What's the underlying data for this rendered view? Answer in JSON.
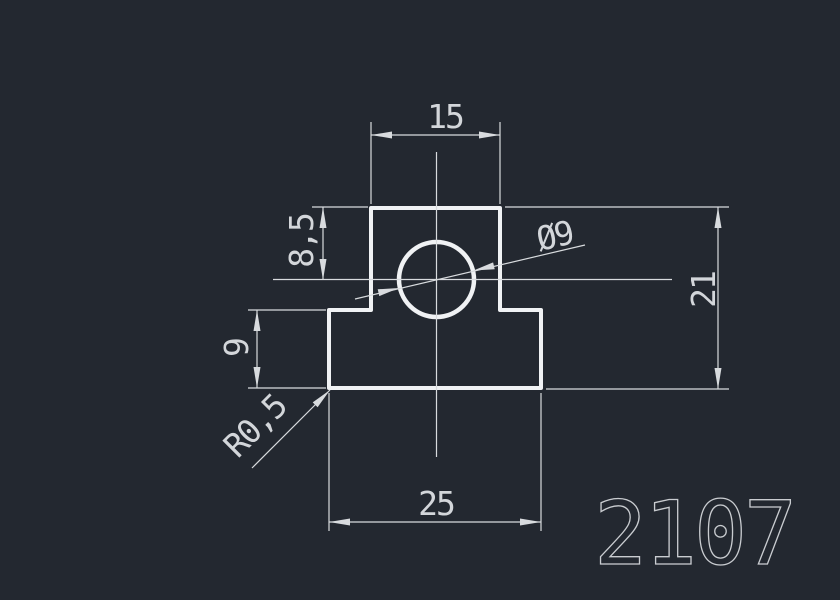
{
  "viewport": {
    "background": "#232830",
    "outline_color": "#f0f2f4",
    "dim_line_color": "#d8dbde",
    "dim_text_color": "#d3d6da",
    "part_number_color": "#c9ccd0"
  },
  "drawing": {
    "type": "cad-profile-drawing",
    "part_number": "2107",
    "dimensions": {
      "top_width": "15",
      "upper_height": "8,5",
      "hole_diameter": "Ø9",
      "total_height": "21",
      "base_height": "9",
      "fillet_radius": "R0,5",
      "base_width": "25"
    }
  }
}
